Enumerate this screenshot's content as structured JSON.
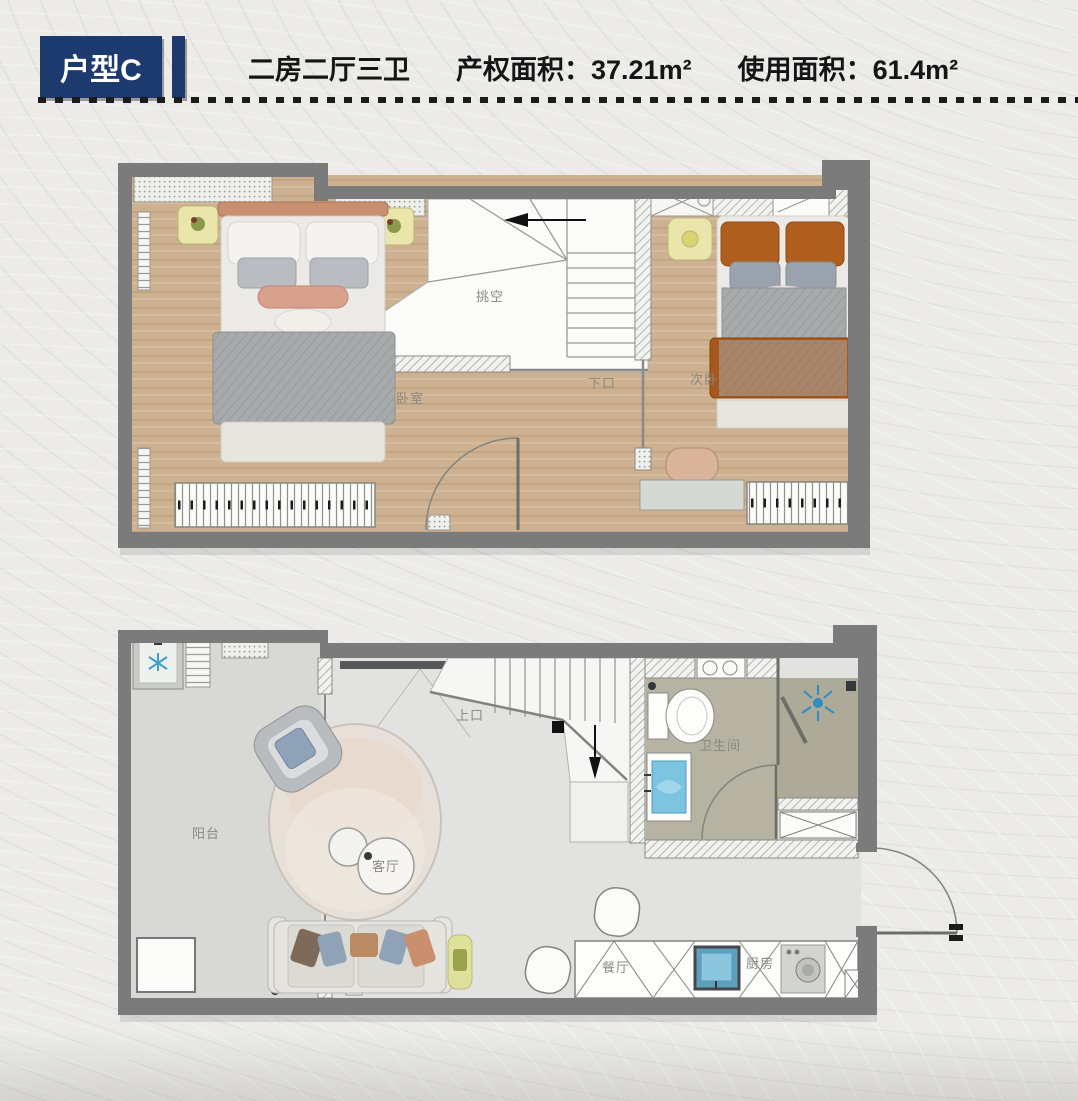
{
  "header": {
    "unit_type": "户型C",
    "layout_summary": "二房二厅三卫",
    "property_area_label": "产权面积：",
    "property_area_value": "37.21m²",
    "usable_area_label": "使用面积：",
    "usable_area_value": "61.4m²"
  },
  "upper_floor": {
    "labels": {
      "master_bedroom": "卧室",
      "void_space": "挑空",
      "stairs_down": "下口",
      "secondary_bedroom": "次卧"
    }
  },
  "lower_floor": {
    "labels": {
      "balcony": "阳台",
      "living_room": "客厅",
      "stairs_up": "上口",
      "bathroom": "卫生间",
      "dining_room": "餐厅",
      "kitchen": "厨房"
    }
  },
  "colors": {
    "accent_navy": "#1d3a6e",
    "wall_gray": "#7b7b7b",
    "wood_floor": "#cdb190",
    "stone_floor": "#e2e2e0",
    "bath_floor": "#b7b3a2",
    "water_blue": "#7cc4e0",
    "pillow_orange": "#b05e1e"
  }
}
